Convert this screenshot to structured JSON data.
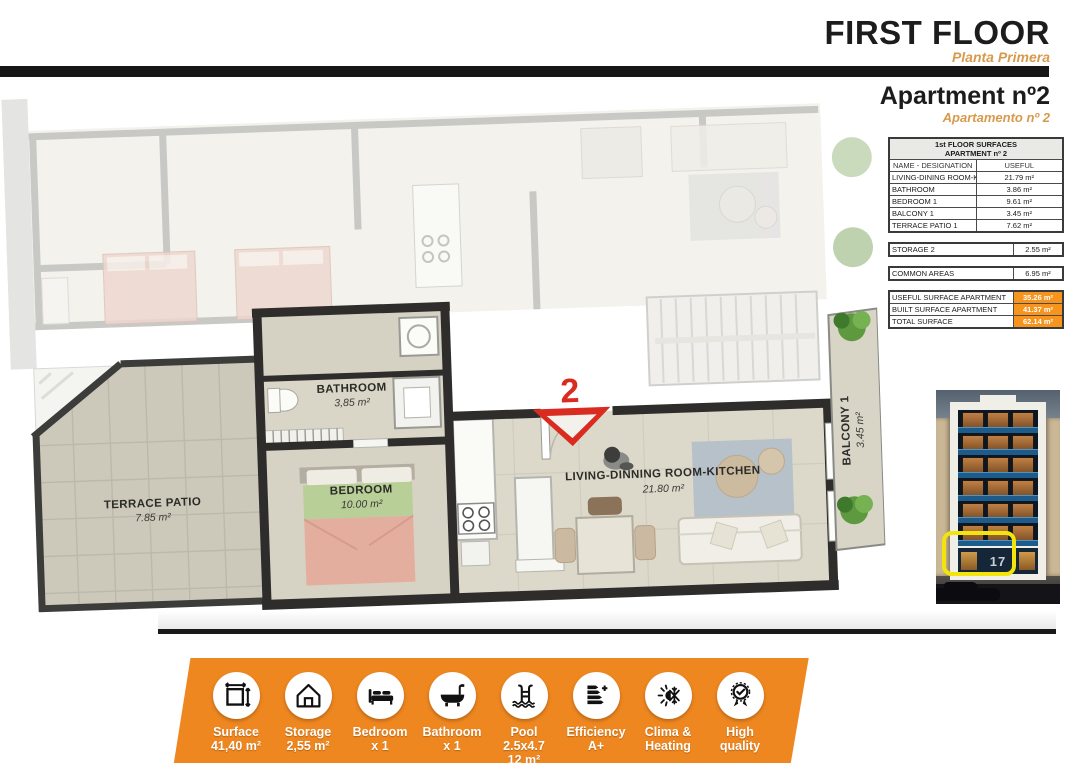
{
  "header": {
    "title": "FIRST FLOOR",
    "subtitle": "Planta Primera",
    "apartment_title": "Apartment nº2",
    "apartment_subtitle": "Apartamento nº 2"
  },
  "surfaces_table": {
    "header_line1": "1st FLOOR SURFACES",
    "header_line2": "APARTMENT nº 2",
    "col_name": "NAME - DESIGNATION",
    "col_useful": "USEFUL",
    "rows": [
      {
        "name": "LIVING-DINING ROOM-KITCHEN",
        "value": "21.79 m²"
      },
      {
        "name": "BATHROOM",
        "value": "3.86 m²"
      },
      {
        "name": "BEDROOM 1",
        "value": "9.61 m²"
      },
      {
        "name": "BALCONY 1",
        "value": "3.45 m²"
      },
      {
        "name": "TERRACE PATIO 1",
        "value": "7.62 m²"
      }
    ],
    "storage_row": {
      "name": "STORAGE 2",
      "value": "2.55 m²"
    },
    "common_row": {
      "name": "COMMON AREAS",
      "value": "6.95 m²"
    },
    "totals": [
      {
        "name": "USEFUL SURFACE APARTMENT",
        "value": "35.26 m²"
      },
      {
        "name": "BUILT SURFACE APARTMENT",
        "value": "41.37 m²"
      },
      {
        "name": "TOTAL SURFACE",
        "value": "62.14 m²"
      }
    ]
  },
  "floor_plan": {
    "entrance_number": "2",
    "labels": {
      "bathroom": {
        "name": "BATHROOM",
        "area": "3,85 m²"
      },
      "bedroom": {
        "name": "BEDROOM",
        "area": "10.00 m²"
      },
      "living": {
        "name": "LIVING-DINNING ROOM-KITCHEN",
        "area": "21.80 m²"
      },
      "terrace": {
        "name": "TERRACE  PATIO",
        "area": "7.85 m²"
      },
      "balcony": {
        "name": "BALCONY 1",
        "area": "3.45 m²"
      }
    }
  },
  "building": {
    "street_number": "17"
  },
  "footer": {
    "items": [
      {
        "icon": "surface-icon",
        "line1": "Surface",
        "line2": "41,40 m²"
      },
      {
        "icon": "storage-icon",
        "line1": "Storage",
        "line2": "2,55 m²"
      },
      {
        "icon": "bedroom-icon",
        "line1": "Bedroom",
        "line2": "x 1"
      },
      {
        "icon": "bathroom-icon",
        "line1": "Bathroom",
        "line2": "x 1"
      },
      {
        "icon": "pool-icon",
        "line1": "Pool 2.5x4.7",
        "line2": "12 m²"
      },
      {
        "icon": "efficiency-icon",
        "line1": "Efficiency",
        "line2": "A+"
      },
      {
        "icon": "clima-icon",
        "line1": "Clima &",
        "line2": "Heating"
      },
      {
        "icon": "quality-icon",
        "line1": "High",
        "line2": "quality"
      }
    ]
  },
  "colors": {
    "accent_orange": "#EE8720",
    "table_highlight_orange": "#F7941D",
    "subtitle_orange": "#D79A4D",
    "entrance_red": "#D92B20",
    "highlight_yellow": "#F2E40C",
    "wall_dark": "#2E2D2B"
  }
}
